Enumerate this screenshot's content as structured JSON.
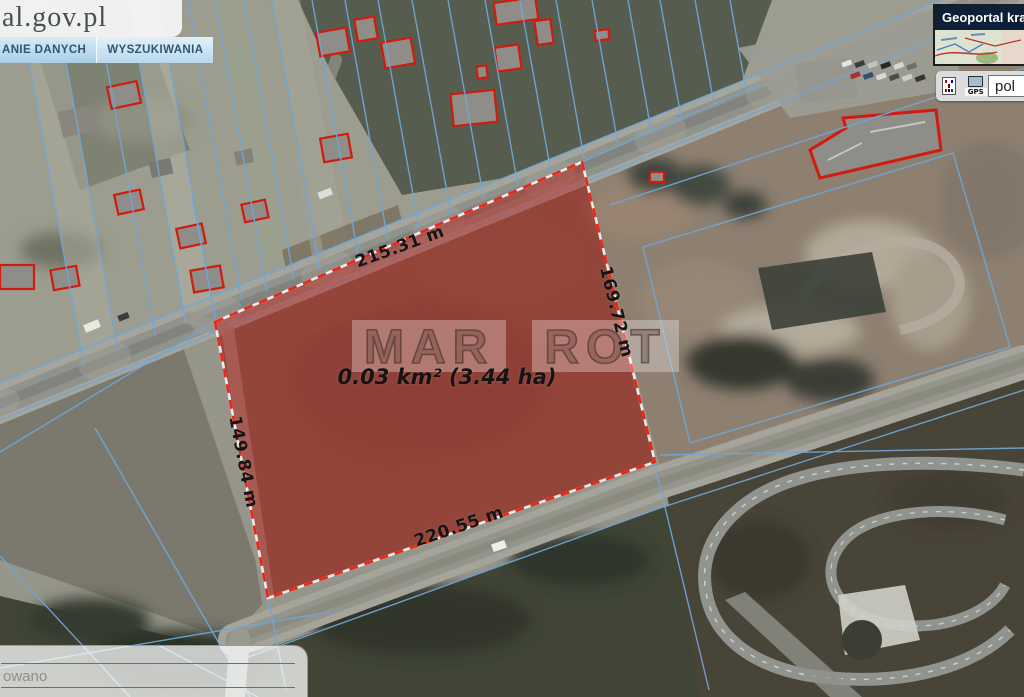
{
  "brand": {
    "logo_text": "al.gov.pl"
  },
  "menu": {
    "items": [
      {
        "label": "ANIE DANYCH"
      },
      {
        "label": "WYSZUKIWANIA"
      }
    ]
  },
  "overview": {
    "title": "Geoportal kra"
  },
  "toolbar": {
    "gps_label": "GPS",
    "input_value": "pol"
  },
  "info_panel": {
    "row_text": "owano"
  },
  "parcel": {
    "watermark_word1": "MAR",
    "watermark_word2": "ROT",
    "area_label": "0.03 km² (3.44 ha)",
    "side_top": "215.31 m",
    "side_right": "169.72 m",
    "side_bottom": "220.55 m",
    "side_left": "149.84 m"
  },
  "colors": {
    "parcel_fill": "#b92a23",
    "parcel_border": "#ee2414",
    "cadastral_blue": "#6fa7da",
    "building_outline_red": "#cf1b10"
  }
}
